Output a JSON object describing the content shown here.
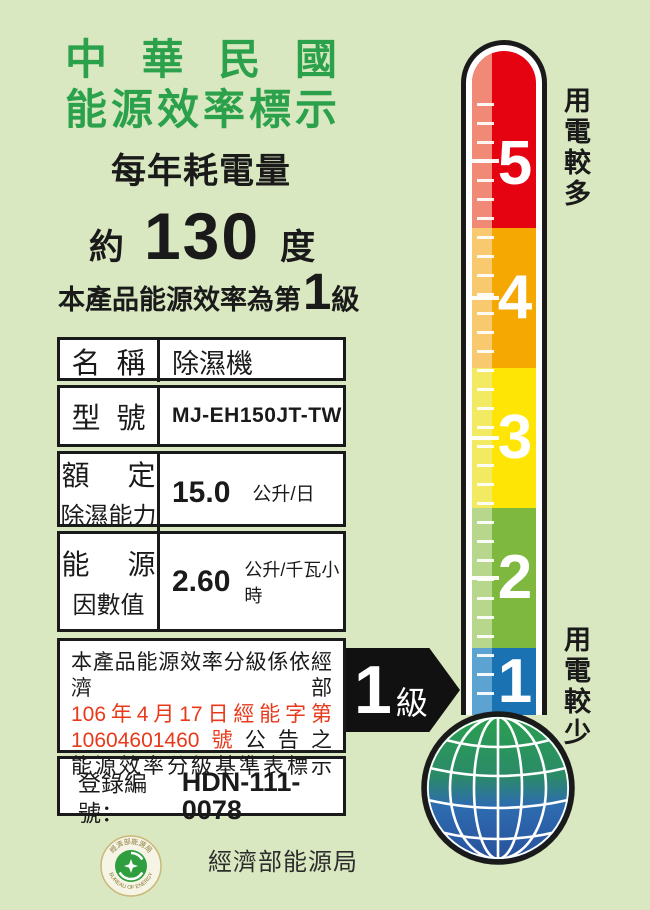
{
  "header": {
    "title_line1": "中華民國",
    "title_line2": "能源效率標示",
    "subtitle": "每年耗電量",
    "approx": "約",
    "annual_kwh": "130",
    "kwh_unit": "度",
    "grade_prefix": "本產品能源效率為第",
    "grade_value": "1",
    "grade_suffix": "級"
  },
  "table": {
    "name_label": "名稱",
    "name_value": "除濕機",
    "model_label": "型號",
    "model_value": "MJ-EH150JT-TW",
    "capacity_label_line1": "額定",
    "capacity_label_line2": "除濕能力",
    "capacity_value": "15.0",
    "capacity_unit": "公升/日",
    "ef_label_line1": "能源",
    "ef_label_line2": "因數值",
    "ef_value": "2.60",
    "ef_unit": "公升/千瓦小時"
  },
  "announcement": {
    "line1": "本產品能源效率分級係依經濟部",
    "line2": "106年4月17日經能字第",
    "line3_red": "10604601460號",
    "line3_black": "公告之",
    "line4": "能源效率分級基準表標示"
  },
  "registration": {
    "label": "登錄編號：",
    "value": "HDN-111-0078"
  },
  "rating_arrow": {
    "value": "1",
    "unit": "級"
  },
  "thermometer": {
    "top_label": "用電較多",
    "bottom_label": "用電較少",
    "segments": [
      {
        "label": "5",
        "color": "#e50312",
        "stripe": "#f08a76"
      },
      {
        "label": "4",
        "color": "#f5a702",
        "stripe": "#f8c96f"
      },
      {
        "label": "3",
        "color": "#ffe506",
        "stripe": "#f2ea62"
      },
      {
        "label": "2",
        "color": "#7fb83e",
        "stripe": "#b7d78c"
      },
      {
        "label": "1",
        "color": "#1b72b2",
        "stripe": "#5ca3d2"
      }
    ]
  },
  "footer": {
    "agency": "經濟部能源局",
    "logo_arc_top": "經濟部能源局",
    "logo_arc_bottom": "BUREAU OF ENERGY"
  },
  "colors": {
    "background": "#d9e8c1",
    "title_green": "#2ca14b",
    "announcement_red": "#e8391b",
    "outline_black": "#1a1a1a"
  }
}
